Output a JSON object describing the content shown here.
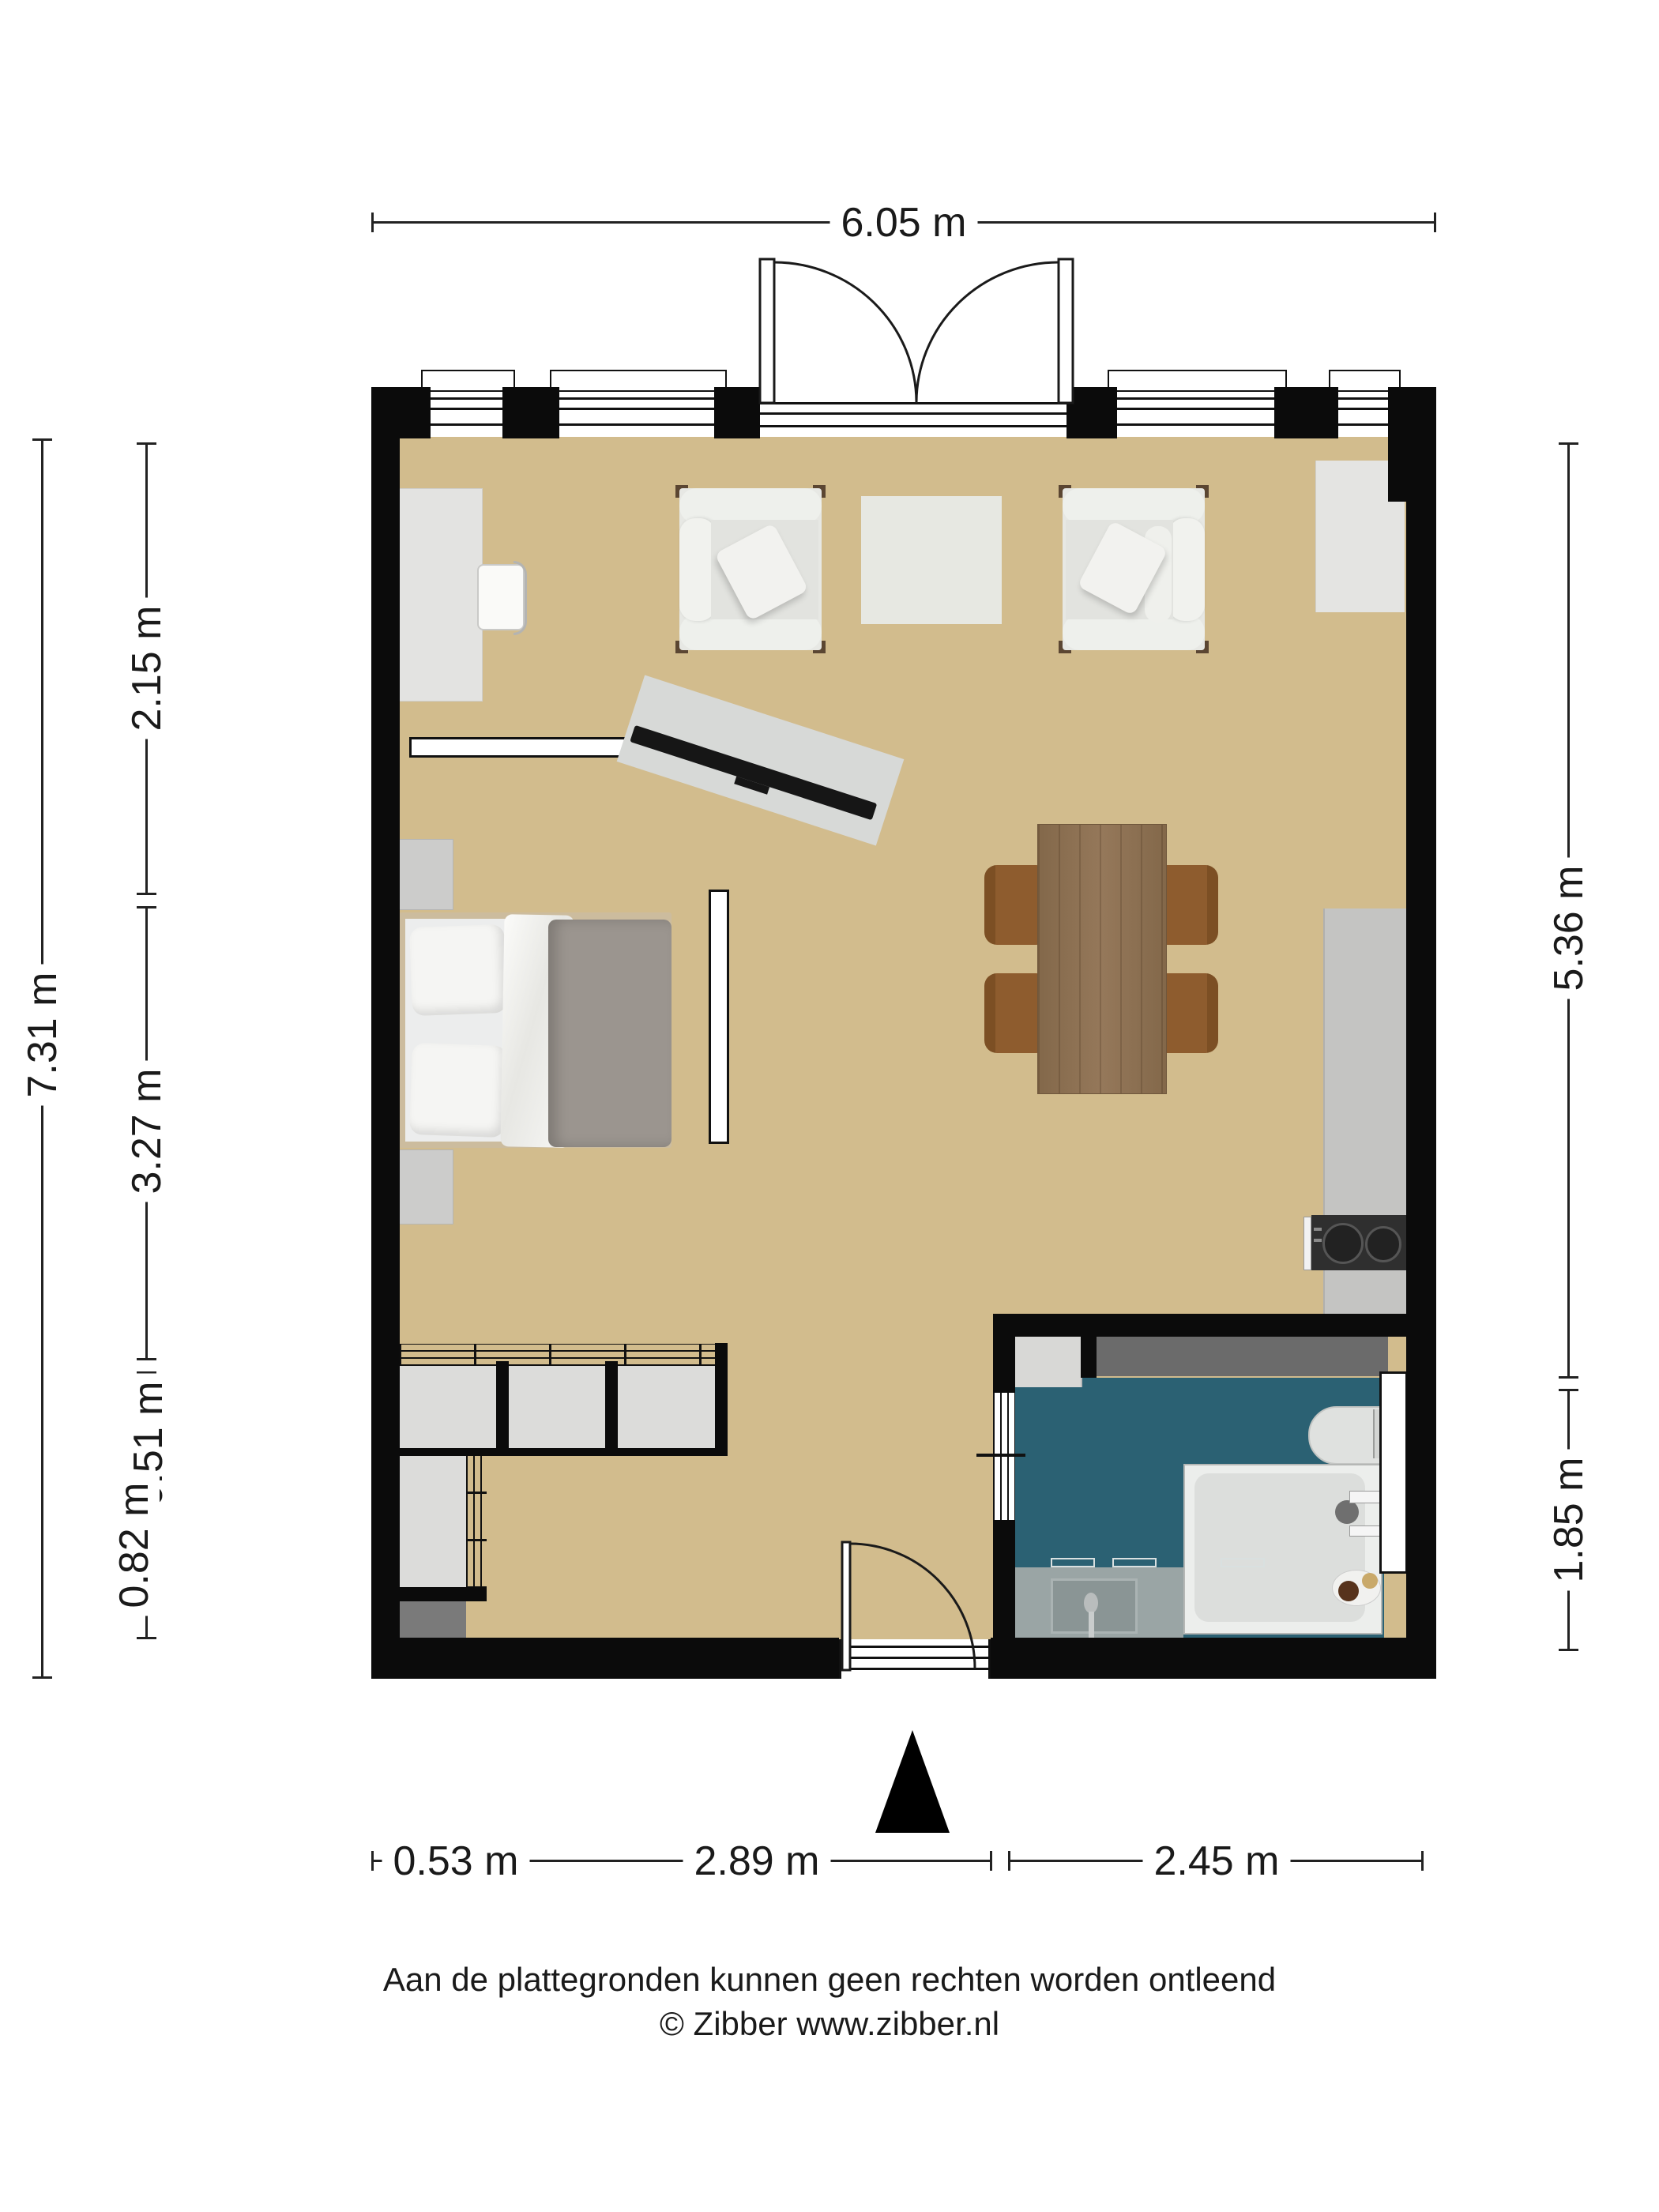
{
  "dimensions": {
    "top": "6.05 m",
    "left_total": "7.31 m",
    "left_segments": [
      "2.15 m",
      "3.27 m",
      "0.51 m",
      "0.82 m"
    ],
    "right_segments": [
      "5.36 m",
      "1.85 m"
    ],
    "bottom_segments": [
      "0.53 m",
      "2.89 m",
      "2.45 m"
    ]
  },
  "footer": {
    "disclaimer": "Aan de plattegronden kunnen geen rechten worden ontleend",
    "copyright": "© Zibber www.zibber.nl"
  },
  "colors": {
    "dim_line": "#222222",
    "wall": "#0b0b0b",
    "floor": "#d2bc8d",
    "bathroom_floor": "#2b6173",
    "wood": "#8a6e50",
    "chair_wood": "#8e5c2e",
    "counter_dark": "#6b6b6b",
    "furniture_light": "#e6e7e3",
    "duvet": "#9b958f",
    "kitchen_counter": "#c4c4c2",
    "cooktop": "#2f2f2f",
    "vanity": "#9aa5a5",
    "dark_gray_cabinet": "#7a7a7a"
  },
  "furniture": [
    "double-bed",
    "nightstand",
    "wardrobe",
    "desk",
    "desk-chair",
    "armchair",
    "side-table",
    "tv-sideboard",
    "wall-shelf",
    "room-divider",
    "dining-table",
    "dining-chair",
    "kitchen-counter",
    "cooktop",
    "washing-machine",
    "toilet",
    "shower",
    "sink-vanity",
    "entrance-door",
    "double-door",
    "north-arrow"
  ]
}
